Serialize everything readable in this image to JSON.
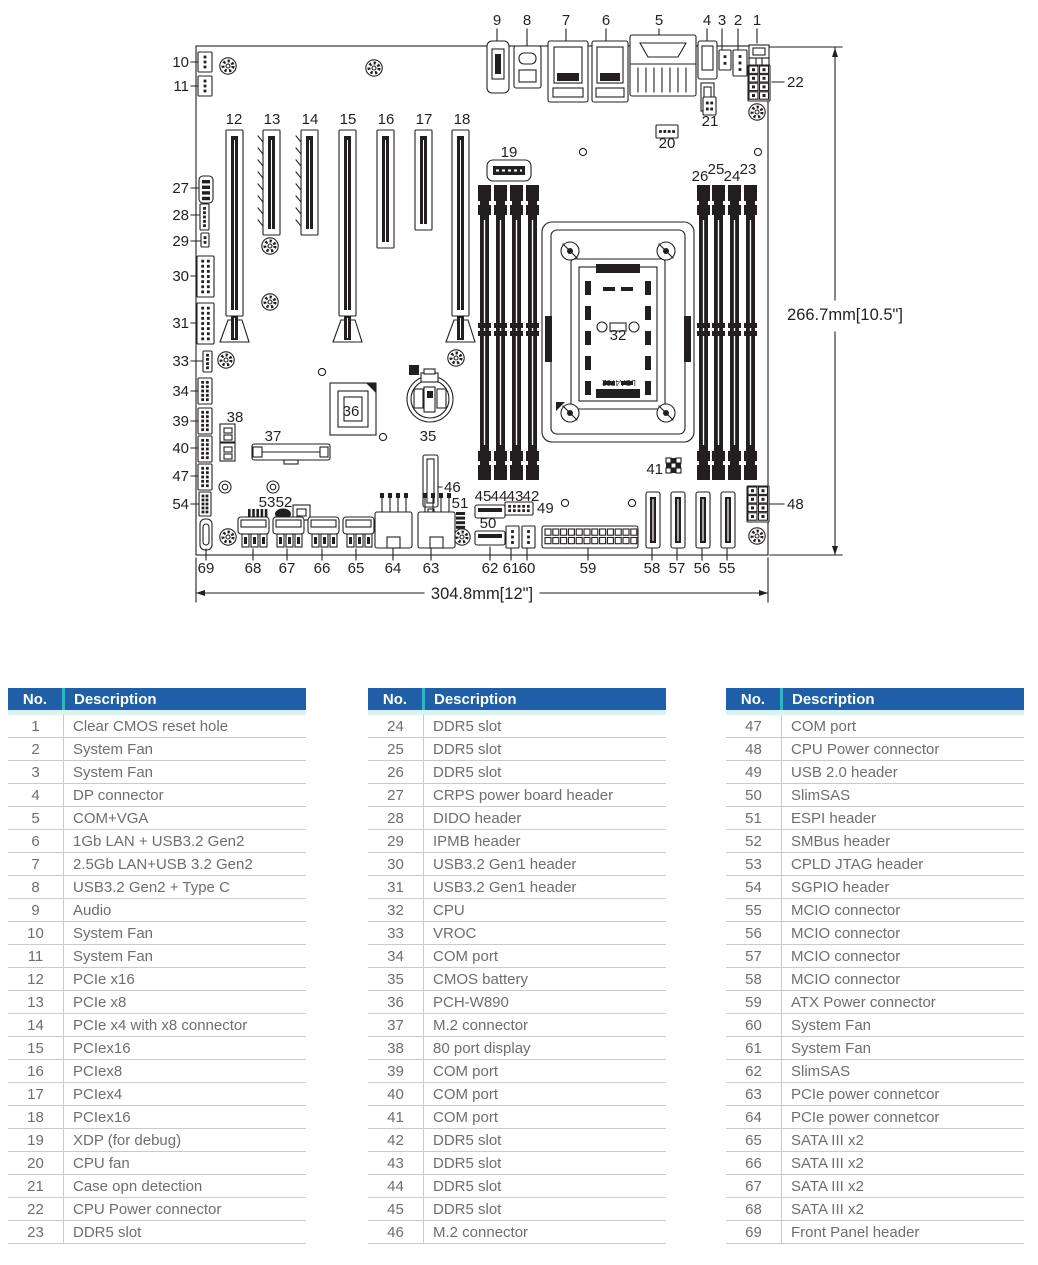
{
  "colors": {
    "header_bg": "#1f5fa8",
    "header_text": "#ffffff",
    "divider_teal": "#30b5c9",
    "band_cyan": "#d9f2f6",
    "row_line": "#c9cacc",
    "body_text": "#6d6e71",
    "ink": "#231f20"
  },
  "diagram": {
    "board_width_label": "304.8mm[12\"]",
    "board_height_label": "266.7mm[10.5\"]",
    "socket_text": "LGA4702",
    "callouts": [
      {
        "t": "9",
        "x": 497,
        "y": 25
      },
      {
        "t": "8",
        "x": 527,
        "y": 25
      },
      {
        "t": "7",
        "x": 566,
        "y": 25
      },
      {
        "t": "6",
        "x": 606,
        "y": 25
      },
      {
        "t": "5",
        "x": 659,
        "y": 25
      },
      {
        "t": "4",
        "x": 707,
        "y": 25
      },
      {
        "t": "3",
        "x": 722,
        "y": 25
      },
      {
        "t": "2",
        "x": 738,
        "y": 25
      },
      {
        "t": "1",
        "x": 757,
        "y": 25
      },
      {
        "t": "10",
        "x": 189,
        "y": 67,
        "a": "e"
      },
      {
        "t": "11",
        "x": 189,
        "y": 91,
        "a": "e"
      },
      {
        "t": "12",
        "x": 234,
        "y": 124
      },
      {
        "t": "13",
        "x": 272,
        "y": 124
      },
      {
        "t": "14",
        "x": 310,
        "y": 124
      },
      {
        "t": "15",
        "x": 348,
        "y": 124
      },
      {
        "t": "16",
        "x": 386,
        "y": 124
      },
      {
        "t": "17",
        "x": 424,
        "y": 124
      },
      {
        "t": "18",
        "x": 462,
        "y": 124
      },
      {
        "t": "19",
        "x": 509,
        "y": 157
      },
      {
        "t": "20",
        "x": 667,
        "y": 148
      },
      {
        "t": "21",
        "x": 710,
        "y": 126
      },
      {
        "t": "22",
        "x": 787,
        "y": 87,
        "a": "s"
      },
      {
        "t": "26",
        "x": 700,
        "y": 181
      },
      {
        "t": "25",
        "x": 716,
        "y": 174
      },
      {
        "t": "24",
        "x": 732,
        "y": 181
      },
      {
        "t": "23",
        "x": 748,
        "y": 174
      },
      {
        "t": "27",
        "x": 189,
        "y": 193,
        "a": "e"
      },
      {
        "t": "28",
        "x": 189,
        "y": 220,
        "a": "e"
      },
      {
        "t": "29",
        "x": 189,
        "y": 246,
        "a": "e"
      },
      {
        "t": "30",
        "x": 189,
        "y": 281,
        "a": "e"
      },
      {
        "t": "31",
        "x": 189,
        "y": 328,
        "a": "e"
      },
      {
        "t": "32",
        "x": 618,
        "y": 340
      },
      {
        "t": "33",
        "x": 189,
        "y": 366,
        "a": "e"
      },
      {
        "t": "34",
        "x": 189,
        "y": 396,
        "a": "e"
      },
      {
        "t": "35",
        "x": 428,
        "y": 441
      },
      {
        "t": "36",
        "x": 351,
        "y": 416
      },
      {
        "t": "37",
        "x": 273,
        "y": 441
      },
      {
        "t": "38",
        "x": 235,
        "y": 422
      },
      {
        "t": "39",
        "x": 189,
        "y": 426,
        "a": "e"
      },
      {
        "t": "40",
        "x": 189,
        "y": 453,
        "a": "e"
      },
      {
        "t": "41",
        "x": 663,
        "y": 474,
        "a": "e"
      },
      {
        "t": "45",
        "x": 483,
        "y": 501
      },
      {
        "t": "44",
        "x": 499,
        "y": 501
      },
      {
        "t": "43",
        "x": 515,
        "y": 501
      },
      {
        "t": "42",
        "x": 531,
        "y": 501
      },
      {
        "t": "46",
        "x": 444,
        "y": 492,
        "a": "s"
      },
      {
        "t": "47",
        "x": 189,
        "y": 481,
        "a": "e"
      },
      {
        "t": "48",
        "x": 787,
        "y": 509,
        "a": "s"
      },
      {
        "t": "49",
        "x": 537,
        "y": 513,
        "a": "s"
      },
      {
        "t": "50",
        "x": 488,
        "y": 528
      },
      {
        "t": "51",
        "x": 460,
        "y": 508
      },
      {
        "t": "52",
        "x": 284,
        "y": 507
      },
      {
        "t": "53",
        "x": 267,
        "y": 507
      },
      {
        "t": "54",
        "x": 189,
        "y": 509,
        "a": "e"
      },
      {
        "t": "55",
        "x": 727,
        "y": 573
      },
      {
        "t": "56",
        "x": 702,
        "y": 573
      },
      {
        "t": "57",
        "x": 677,
        "y": 573
      },
      {
        "t": "58",
        "x": 652,
        "y": 573
      },
      {
        "t": "59",
        "x": 588,
        "y": 573
      },
      {
        "t": "60",
        "x": 527,
        "y": 573
      },
      {
        "t": "61",
        "x": 511,
        "y": 573
      },
      {
        "t": "62",
        "x": 490,
        "y": 573
      },
      {
        "t": "63",
        "x": 431,
        "y": 573
      },
      {
        "t": "64",
        "x": 393,
        "y": 573
      },
      {
        "t": "65",
        "x": 356,
        "y": 573
      },
      {
        "t": "66",
        "x": 322,
        "y": 573
      },
      {
        "t": "67",
        "x": 287,
        "y": 573
      },
      {
        "t": "68",
        "x": 253,
        "y": 573
      },
      {
        "t": "69",
        "x": 206,
        "y": 573
      }
    ]
  },
  "tables": [
    {
      "headers": {
        "no": "No.",
        "desc": "Description"
      },
      "rows": [
        {
          "no": "1",
          "desc": "Clear CMOS reset hole"
        },
        {
          "no": "2",
          "desc": "System Fan"
        },
        {
          "no": "3",
          "desc": "System Fan"
        },
        {
          "no": "4",
          "desc": "DP connector"
        },
        {
          "no": "5",
          "desc": "COM+VGA"
        },
        {
          "no": "6",
          "desc": "1Gb LAN + USB3.2 Gen2"
        },
        {
          "no": "7",
          "desc": "2.5Gb LAN+USB 3.2 Gen2"
        },
        {
          "no": "8",
          "desc": "USB3.2 Gen2 + Type C"
        },
        {
          "no": "9",
          "desc": "Audio"
        },
        {
          "no": "10",
          "desc": "System Fan"
        },
        {
          "no": "11",
          "desc": "System Fan"
        },
        {
          "no": "12",
          "desc": "PCIe x16"
        },
        {
          "no": "13",
          "desc": "PCIe x8"
        },
        {
          "no": "14",
          "desc": "PCIe x4 with x8 connector"
        },
        {
          "no": "15",
          "desc": "PCIex16"
        },
        {
          "no": "16",
          "desc": "PCIex8"
        },
        {
          "no": "17",
          "desc": "PCIex4"
        },
        {
          "no": "18",
          "desc": "PCIex16"
        },
        {
          "no": "19",
          "desc": "XDP (for debug)"
        },
        {
          "no": "20",
          "desc": "CPU fan"
        },
        {
          "no": "21",
          "desc": "Case opn detection"
        },
        {
          "no": "22",
          "desc": "CPU Power connector"
        },
        {
          "no": "23",
          "desc": "DDR5 slot"
        }
      ]
    },
    {
      "headers": {
        "no": "No.",
        "desc": "Description"
      },
      "rows": [
        {
          "no": "24",
          "desc": "DDR5 slot"
        },
        {
          "no": "25",
          "desc": "DDR5 slot"
        },
        {
          "no": "26",
          "desc": "DDR5 slot"
        },
        {
          "no": "27",
          "desc": "CRPS power board header"
        },
        {
          "no": "28",
          "desc": "DIDO  header"
        },
        {
          "no": "29",
          "desc": "IPMB header"
        },
        {
          "no": "30",
          "desc": "USB3.2 Gen1 header"
        },
        {
          "no": "31",
          "desc": "USB3.2 Gen1 header"
        },
        {
          "no": "32",
          "desc": "CPU"
        },
        {
          "no": "33",
          "desc": "VROC"
        },
        {
          "no": "34",
          "desc": "COM port"
        },
        {
          "no": "35",
          "desc": "CMOS battery"
        },
        {
          "no": "36",
          "desc": "PCH-W890"
        },
        {
          "no": "37",
          "desc": "M.2 connector"
        },
        {
          "no": "38",
          "desc": "80 port display"
        },
        {
          "no": "39",
          "desc": "COM port"
        },
        {
          "no": "40",
          "desc": "COM port"
        },
        {
          "no": "41",
          "desc": "COM port"
        },
        {
          "no": "42",
          "desc": "DDR5 slot"
        },
        {
          "no": "43",
          "desc": "DDR5 slot"
        },
        {
          "no": "44",
          "desc": "DDR5 slot"
        },
        {
          "no": "45",
          "desc": "DDR5 slot"
        },
        {
          "no": "46",
          "desc": "M.2 connector"
        }
      ]
    },
    {
      "headers": {
        "no": "No.",
        "desc": "Description"
      },
      "rows": [
        {
          "no": "47",
          "desc": "COM port"
        },
        {
          "no": "48",
          "desc": "CPU Power connector"
        },
        {
          "no": "49",
          "desc": "USB 2.0 header"
        },
        {
          "no": "50",
          "desc": "SlimSAS"
        },
        {
          "no": "51",
          "desc": "ESPI header"
        },
        {
          "no": "52",
          "desc": "SMBus header"
        },
        {
          "no": "53",
          "desc": "CPLD JTAG header"
        },
        {
          "no": "54",
          "desc": "SGPIO header"
        },
        {
          "no": "55",
          "desc": "MCIO connector"
        },
        {
          "no": "56",
          "desc": "MCIO connector"
        },
        {
          "no": "57",
          "desc": "MCIO connector"
        },
        {
          "no": "58",
          "desc": "MCIO connector"
        },
        {
          "no": "59",
          "desc": "ATX Power connector"
        },
        {
          "no": "60",
          "desc": "System Fan"
        },
        {
          "no": "61",
          "desc": "System Fan"
        },
        {
          "no": "62",
          "desc": "SlimSAS"
        },
        {
          "no": "63",
          "desc": "PCIe power connetcor"
        },
        {
          "no": "64",
          "desc": "PCIe power connetcor"
        },
        {
          "no": "65",
          "desc": "SATA III x2"
        },
        {
          "no": "66",
          "desc": "SATA III x2"
        },
        {
          "no": "67",
          "desc": "SATA III x2"
        },
        {
          "no": "68",
          "desc": "SATA III x2"
        },
        {
          "no": "69",
          "desc": "Front Panel header"
        }
      ]
    }
  ]
}
